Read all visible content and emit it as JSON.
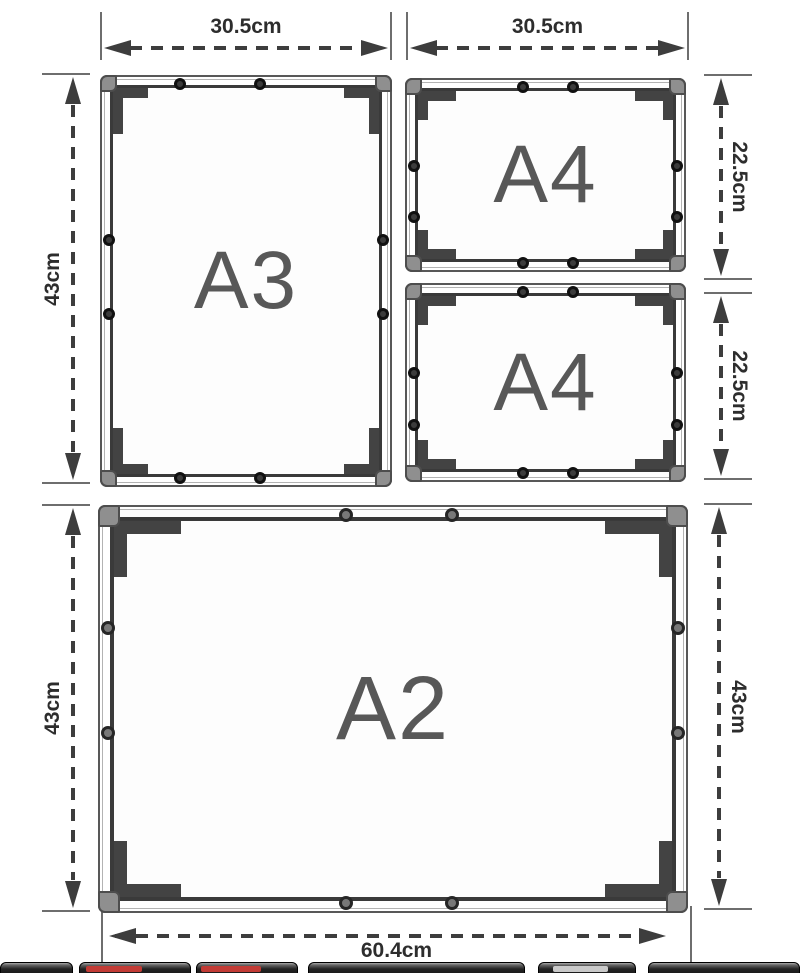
{
  "diagram_title": "snap frame size diagram",
  "frames": [
    {
      "id": "a3",
      "label": "A3"
    },
    {
      "id": "a4-top",
      "label": "A4"
    },
    {
      "id": "a4-bottom",
      "label": "A4"
    },
    {
      "id": "a2",
      "label": "A2"
    }
  ],
  "dims": {
    "a3_width": "30.5cm",
    "a4_width": "30.5cm",
    "a3_height": "43cm",
    "a4_top_height": "22.5cm",
    "a4_bottom_height": "22.5cm",
    "a2_height_left": "43cm",
    "a2_height_right": "43cm",
    "a2_width": "60.4cm"
  },
  "colors": {
    "dimension_line": "#3d3d3d",
    "label_text": "#2d2d2d",
    "frame_border": "#585858",
    "bracket": "#434343",
    "corner_cap": "#8f8f8f",
    "size_text": "#585858",
    "strip_red": "#c23b35"
  }
}
